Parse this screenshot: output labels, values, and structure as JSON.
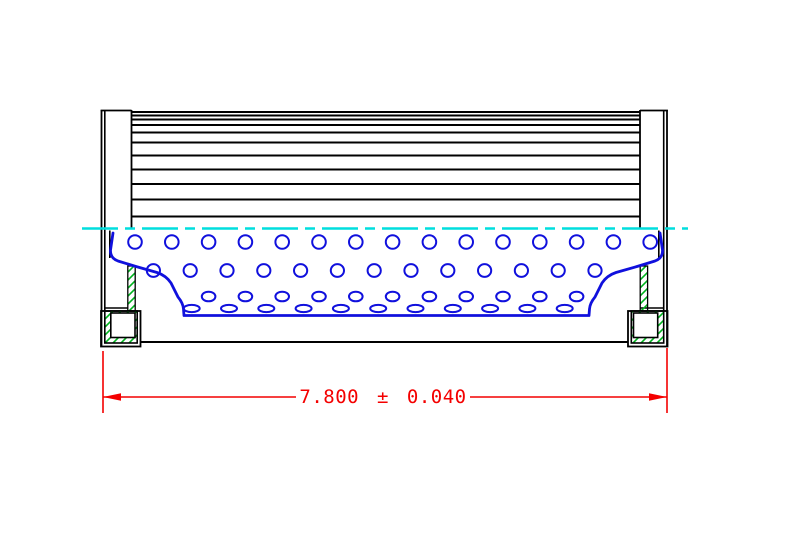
{
  "drawing": {
    "title": "filter-element-cross-section",
    "dimension": {
      "label": "7.800 ± 0.040",
      "value": "7.800",
      "tolerance": "0.040"
    },
    "colors": {
      "outline": "#000000",
      "core_blue": "#1010dd",
      "centerline_cyan": "#00dede",
      "hatch_green": "#00b41e",
      "dimension_red": "#f40000",
      "background": "#ffffff"
    },
    "pleat_lines": {
      "ys": [
        112,
        115.5,
        119.5,
        125,
        132.5,
        142.5,
        155.5,
        169.5,
        184,
        199.5,
        216.5
      ],
      "x1": 131.5,
      "x2": 640
    },
    "perforation_rows": [
      {
        "y": 242,
        "rx": 6.8,
        "ry": 6.8,
        "x0": 135,
        "dx": 36.8,
        "count": 15
      },
      {
        "y": 270.5,
        "rx": 6.6,
        "ry": 6.4,
        "x0": 153.4,
        "dx": 36.8,
        "count": 13
      },
      {
        "y": 296.5,
        "rx": 6.8,
        "ry": 4.8,
        "x0": 208.6,
        "dx": 36.8,
        "count": 11
      },
      {
        "y": 308.5,
        "rx": 8.0,
        "ry": 3.6,
        "x0": 191.7,
        "dx": 37.3,
        "count": 11
      }
    ],
    "centerline": {
      "y": 228.5,
      "x1": 82,
      "x2": 688
    }
  }
}
